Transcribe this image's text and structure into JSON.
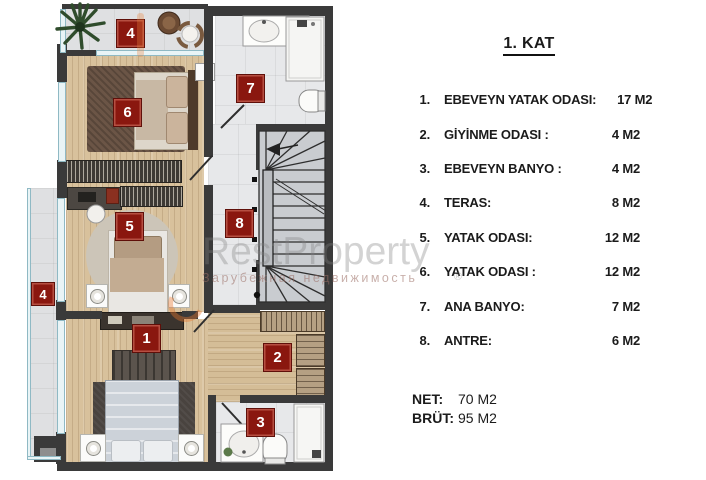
{
  "legend": {
    "title": "1. KAT",
    "items": [
      {
        "no": "1.",
        "label": "EBEVEYN YATAK ODASI:",
        "area": "17 M2"
      },
      {
        "no": "2.",
        "label": "GİYİNME ODASI :",
        "area": "4 M2"
      },
      {
        "no": "3.",
        "label": "EBEVEYN BANYO :",
        "area": "4 M2"
      },
      {
        "no": "4.",
        "label": "TERAS:",
        "area": "8 M2"
      },
      {
        "no": "5.",
        "label": "YATAK ODASI:",
        "area": "12 M2"
      },
      {
        "no": "6.",
        "label": "YATAK ODASI :",
        "area": "12 M2"
      },
      {
        "no": "7.",
        "label": "ANA BANYO:",
        "area": "7 M2"
      },
      {
        "no": "8.",
        "label": "ANTRE:",
        "area": "6 M2"
      }
    ],
    "net_label": "NET:",
    "net_value": "70 M2",
    "brut_label": "BRÜT:",
    "brut_value": "95 M2"
  },
  "floorplan": {
    "badges": [
      {
        "room": "teras-top",
        "number": "4"
      },
      {
        "room": "ana-banyo",
        "number": "7"
      },
      {
        "room": "yatak-odasi-6",
        "number": "6"
      },
      {
        "room": "yatak-odasi-5",
        "number": "5"
      },
      {
        "room": "antre",
        "number": "8"
      },
      {
        "room": "teras-left",
        "number": "4"
      },
      {
        "room": "ebeveyn-yatak-odasi",
        "number": "1"
      },
      {
        "room": "giyinme-odasi",
        "number": "2"
      },
      {
        "room": "ebeveyn-banyo",
        "number": "3"
      }
    ],
    "watermark": {
      "brand": "RestProperty",
      "subtitle": "Зарубежная недвижимость",
      "reg": "®"
    }
  },
  "colors": {
    "badge_red": "#8a170f",
    "wall": "#3a3a3a",
    "wood": "#d8c19c",
    "tile": "#e7e8ea",
    "accent_orange": "#e07a35"
  }
}
